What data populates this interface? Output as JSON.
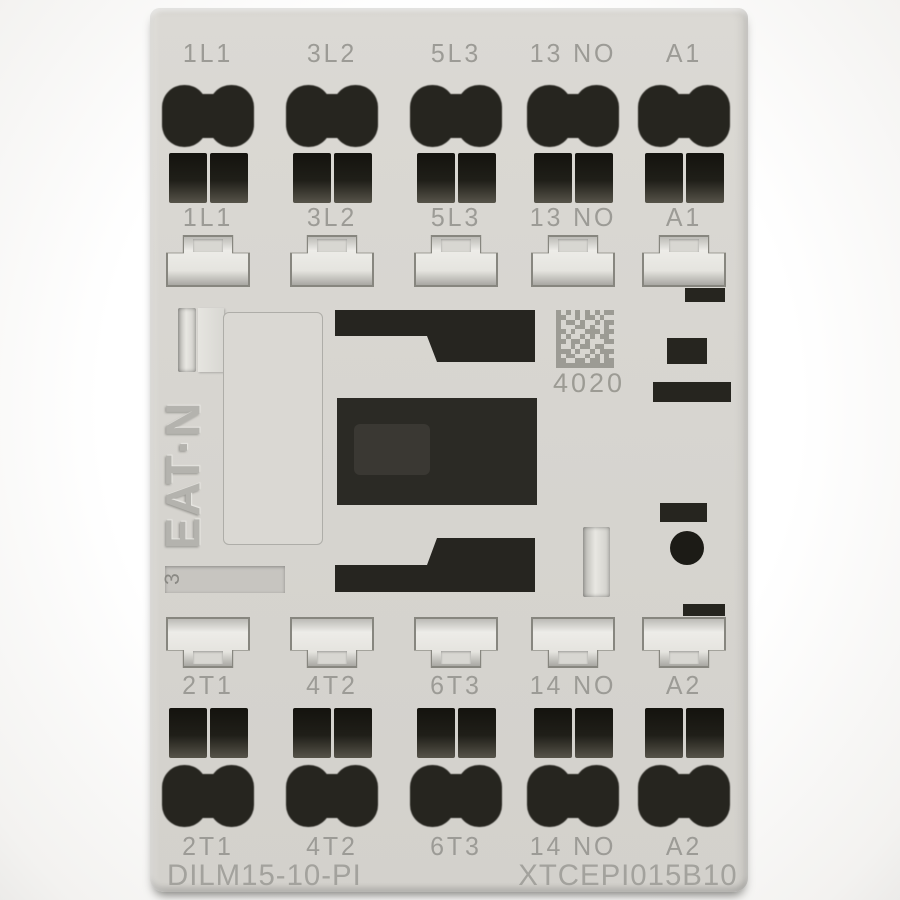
{
  "product": {
    "brand_logo": "EAT·N",
    "model_number": "DILM15-10-PI",
    "catalog_number": "XTCEPI015B10",
    "dmc_number": "4020",
    "marker_label": "3"
  },
  "terminals": {
    "top_row_labels": [
      "1L1",
      "3L2",
      "5L3",
      "13 NO",
      "A1"
    ],
    "top_clip_labels": [
      "1L1",
      "3L2",
      "5L3",
      "13 NO",
      "A1"
    ],
    "bottom_clip_labels": [
      "2T1",
      "4T2",
      "6T3",
      "14 NO",
      "A2"
    ],
    "bottom_row_labels": [
      "2T1",
      "4T2",
      "6T3",
      "14 NO",
      "A2"
    ]
  },
  "colors": {
    "body": "#d7d5d0",
    "label_text": "#9c9b96",
    "terminal_hole": "#26251f",
    "clip_face": "#e8e7e2",
    "print_gray": "#9c9b94"
  },
  "dmc_pattern": [
    "101010101011",
    "110010110100",
    "101101001011",
    "100011010010",
    "110100111011",
    "101001010110",
    "110110100011",
    "100101101100",
    "111010010111",
    "101100101010",
    "110011011011",
    "111111111111"
  ]
}
